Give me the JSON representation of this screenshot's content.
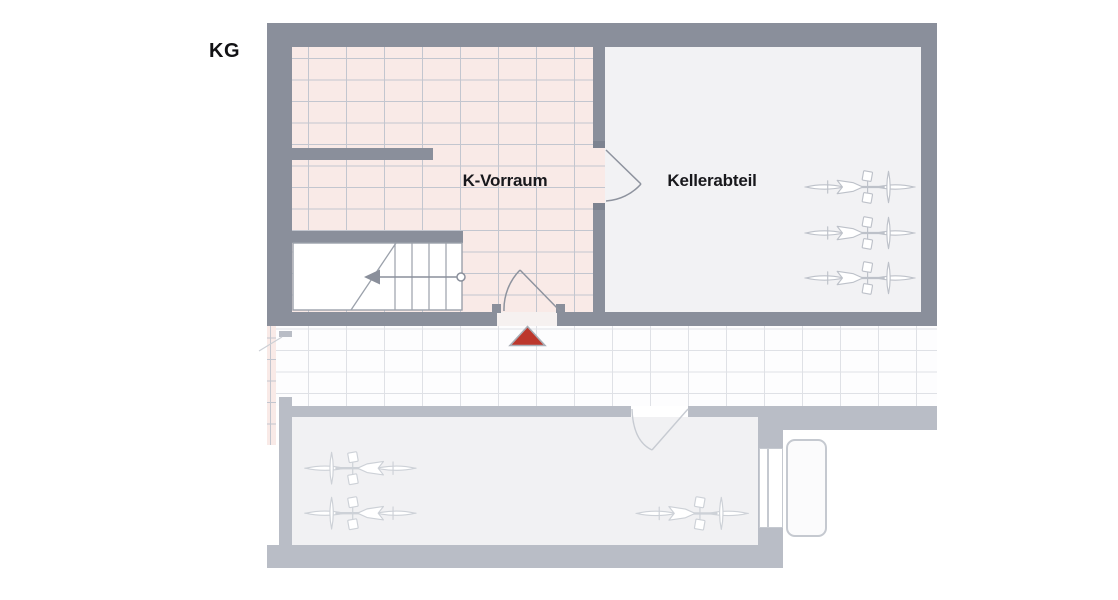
{
  "labels": {
    "kg": "KG",
    "k_vorraum": "K-Vorraum",
    "kellerabteil": "Kellerabteil"
  },
  "plan": {
    "floor": "KG",
    "rooms": [
      {
        "name": "K-Vorraum",
        "floor_finish": "pink-tiles"
      },
      {
        "name": "Kellerabteil",
        "floor_finish": "plain"
      },
      {
        "name": "corridor",
        "floor_finish": "white-tiles"
      },
      {
        "name": "lower-room",
        "floor_finish": "plain",
        "state": "faded"
      }
    ],
    "symbols": {
      "bikes_kellerabteil": 3,
      "bikes_lower_room_left": 2,
      "bikes_lower_room_right": 1,
      "stairs": 1,
      "door_swings": 4,
      "entrance_marker": 1
    },
    "colors": {
      "wall": "#8a8f9b",
      "wall_faded": "#b9bdc6",
      "tile_pink": "#f9eae7",
      "tile_grout": "#c3c6cf",
      "floor_light": "#f2f2f4",
      "entrance_marker_red": "#bc372c",
      "text": "#18181c"
    }
  }
}
